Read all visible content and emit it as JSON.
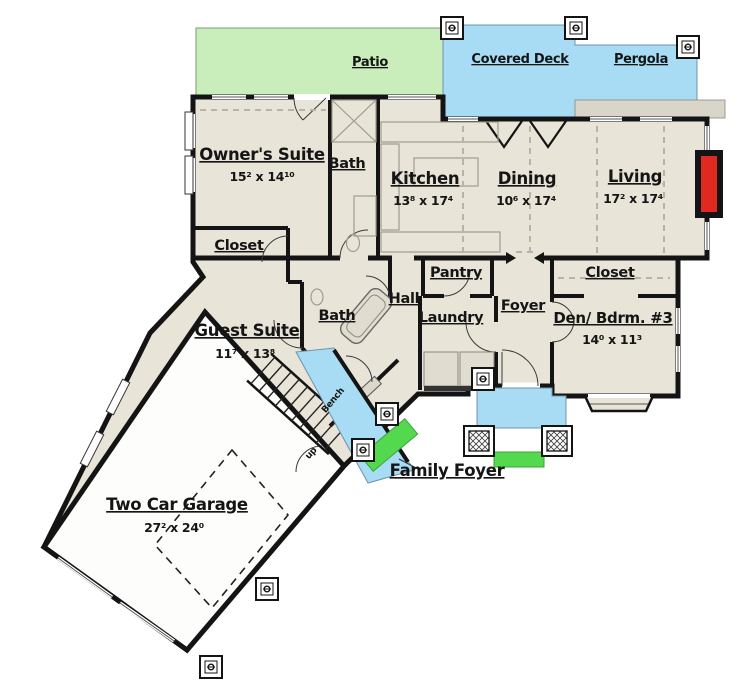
{
  "floor_plan": {
    "areas": {
      "patio": {
        "label": "Patio"
      },
      "covered_deck": {
        "label": "Covered Deck"
      },
      "pergola": {
        "label": "Pergola"
      },
      "family_foyer": {
        "label": "Family Foyer"
      }
    },
    "rooms": {
      "owners_suite": {
        "label": "Owner's Suite",
        "dims": "15² x 14¹⁰"
      },
      "bath_main": {
        "label": "Bath"
      },
      "closet_owner": {
        "label": "Closet"
      },
      "kitchen": {
        "label": "Kitchen",
        "dims": "13⁸ x 17⁴"
      },
      "dining": {
        "label": "Dining",
        "dims": "10⁶ x 17⁴"
      },
      "living": {
        "label": "Living",
        "dims": "17² x 17⁴"
      },
      "pantry": {
        "label": "Pantry"
      },
      "hall": {
        "label": "Hall"
      },
      "laundry": {
        "label": "Laundry"
      },
      "foyer": {
        "label": "Foyer"
      },
      "closet_den": {
        "label": "Closet"
      },
      "den": {
        "label": "Den/ Bdrm. #3",
        "dims": "14⁰ x 11³"
      },
      "bath_guest": {
        "label": "Bath"
      },
      "guest_suite": {
        "label": "Guest Suite",
        "dims": "11⁷ x 13⁸"
      },
      "garage": {
        "label": "Two Car Garage",
        "dims": "27² x 24⁰"
      }
    },
    "annotations": {
      "bench": {
        "label": "Bench"
      },
      "up": {
        "label": "up"
      }
    },
    "colors": {
      "floor": "#e8e4d8",
      "garage_floor": "#fdfdfb",
      "wall": "#141414",
      "patio": "#c9eebc",
      "deck": "#a8dbf4",
      "walkway": "#a8dbf4",
      "porch": "#a8dbf4",
      "step": "#54d84e",
      "fireplace": "#e02a20"
    }
  }
}
